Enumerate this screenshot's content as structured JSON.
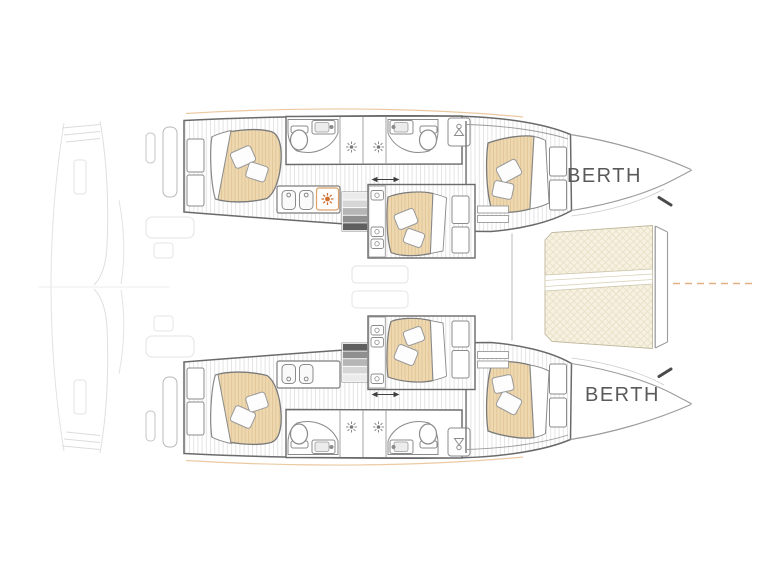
{
  "labels": {
    "berth_top": "BERTH",
    "berth_bottom": "BERTH"
  },
  "icons": {
    "stove": "stove-burner-icon",
    "shower": "shower-head-icon",
    "toilet": "toilet-icon",
    "sink": "sink-icon",
    "wardrobe": "wardrobe-hanger-icon",
    "sliding_door": "sliding-door-arrow-icon"
  },
  "colors": {
    "background": "#ffffff",
    "mattress": "#edd8b0",
    "mattress_stripe": "#e0c394",
    "trampoline": "#f7f1e2",
    "trampoline_hatch": "#e9e0c6",
    "stove_burner": "#cf6f2e",
    "sheer_accent": "#ecc9a2",
    "bowsprit_line": "#e2b183",
    "wall": "#6a6a6a",
    "fixture": "#8b8b8b",
    "hull_edge": "#9c9c9c",
    "floor_stripe": "#e4e4e4",
    "label_text": "#5a5a5a"
  }
}
